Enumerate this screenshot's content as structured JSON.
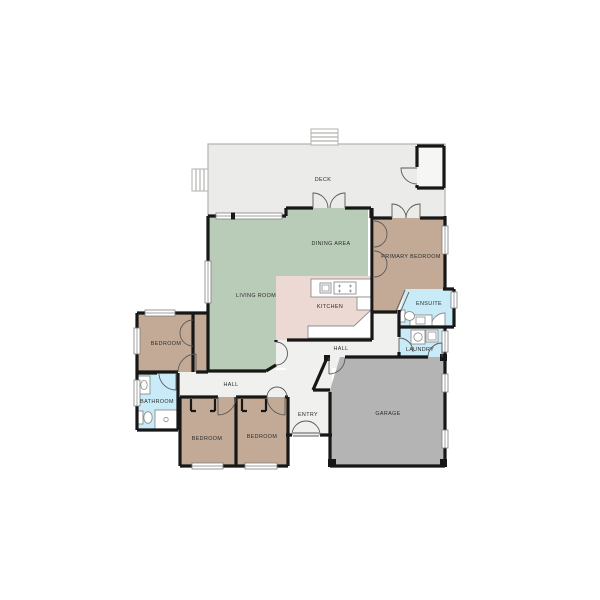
{
  "title": "Residential floor plan",
  "colors": {
    "wall": "#171717",
    "deck": "#ebebe9",
    "living": "#b9ccb8",
    "bedroom": "#c3aa96",
    "kitchen": "#edd9d3",
    "wet_room": "#c9ebf7",
    "hall": "#f0f0ee",
    "garage": "#b4b4b4",
    "label": "#2b2b2b",
    "background": "#ffffff"
  },
  "rooms": {
    "deck": {
      "label": "DECK"
    },
    "dining": {
      "label": "DINING AREA"
    },
    "living": {
      "label": "LIVING ROOM"
    },
    "kitchen": {
      "label": "KITCHEN"
    },
    "primary_bedroom": {
      "label": "PRIMARY BEDROOM"
    },
    "ensuite": {
      "label": "ENSUITE"
    },
    "laundry": {
      "label": "LAUNDRY"
    },
    "hall_upper": {
      "label": "HALL"
    },
    "hall_lower": {
      "label": "HALL"
    },
    "garage": {
      "label": "GARAGE"
    },
    "entry": {
      "label": "ENTRY"
    },
    "bedroom_left": {
      "label": "BEDROOM"
    },
    "bathroom": {
      "label": "BATHROOM"
    },
    "bedroom_mid": {
      "label": "BEDROOM"
    },
    "bedroom_right": {
      "label": "BEDROOM"
    }
  },
  "fixtures": [
    "deck-stairs-top",
    "deck-stairs-left",
    "deck-storage-closet",
    "kitchen-island-counter",
    "kitchen-sink",
    "kitchen-cooktop",
    "kitchen-fridge",
    "kitchen-counter",
    "ensuite-corner-shower",
    "ensuite-vanity",
    "ensuite-toilet",
    "laundry-washer",
    "laundry-tub",
    "bathroom-vanity",
    "bathroom-toilet",
    "bathroom-shower",
    "bedroom-closets",
    "primary-closets",
    "entry-double-door",
    "garage-door-arc"
  ]
}
